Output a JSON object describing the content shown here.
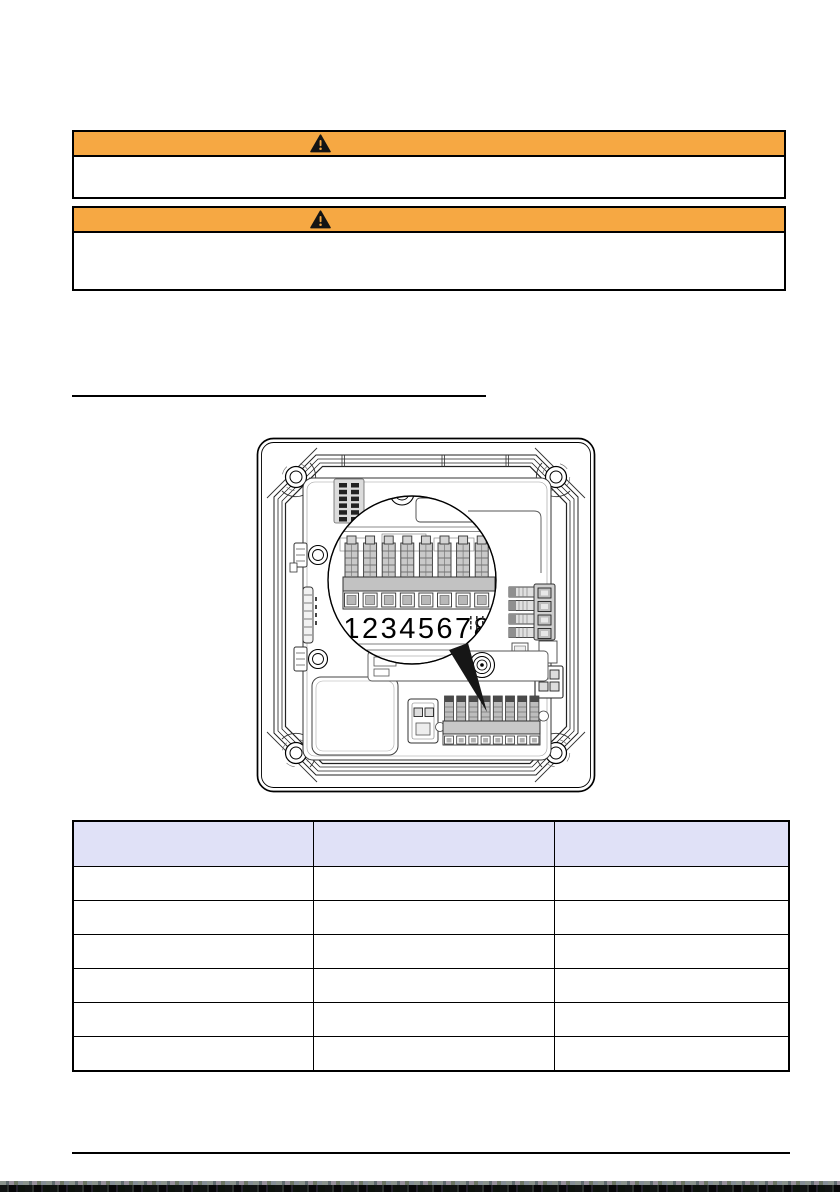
{
  "colors": {
    "warning_header_bg": "#F6A843",
    "table_header_bg": "#E0E1F7",
    "rule_color": "#000000"
  },
  "warning_boxes": [
    {
      "icon": "warning-triangle",
      "title_text": "",
      "body_text": ""
    },
    {
      "icon": "warning-triangle",
      "title_text": "",
      "body_text": ""
    }
  ],
  "section_heading": {
    "text": ""
  },
  "figure": {
    "terminal_labels": [
      "1",
      "2",
      "3",
      "4",
      "5",
      "6",
      "7",
      "8"
    ]
  },
  "table": {
    "columns": [
      "",
      "",
      ""
    ],
    "rows": [
      [
        "",
        "",
        ""
      ],
      [
        "",
        "",
        ""
      ],
      [
        "",
        "",
        ""
      ],
      [
        "",
        "",
        ""
      ],
      [
        "",
        "",
        ""
      ],
      [
        "",
        "",
        ""
      ]
    ]
  }
}
